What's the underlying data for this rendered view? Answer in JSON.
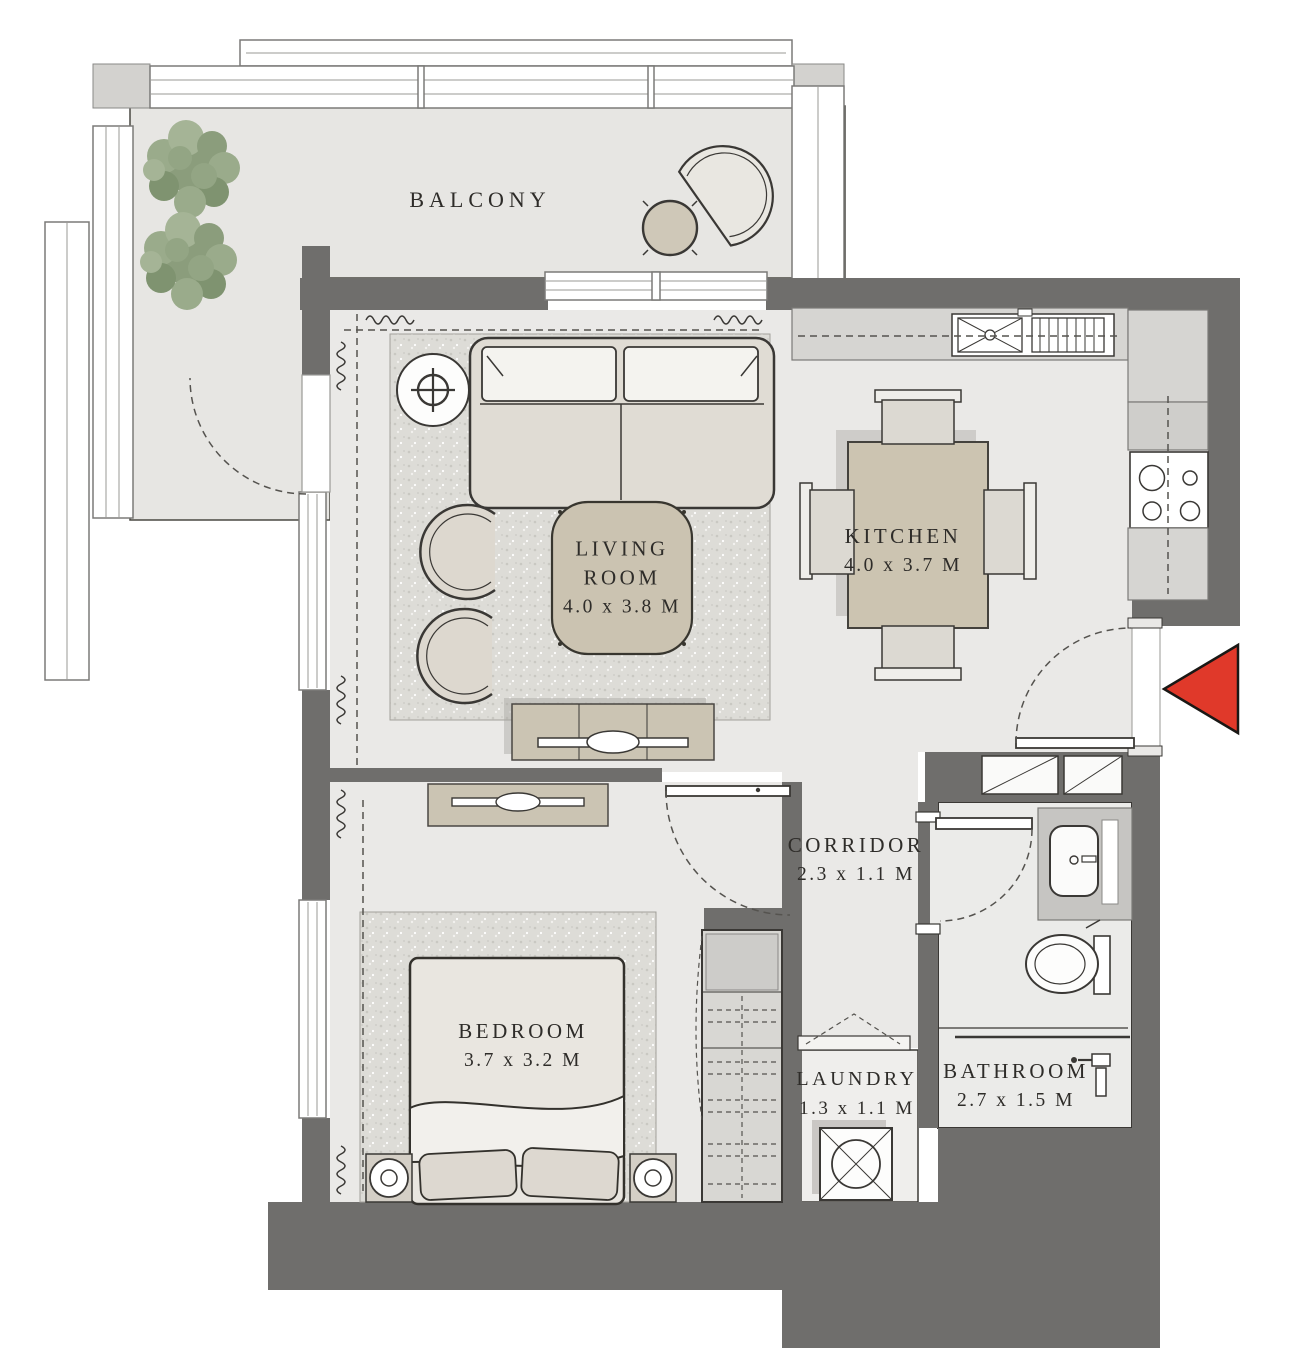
{
  "plan": {
    "type": "apartment-floor-plan",
    "rooms": {
      "balcony": {
        "name": "BALCONY"
      },
      "living_room": {
        "name_line1": "LIVING",
        "name_line2": "ROOM",
        "dims": "4.0 x 3.8 M"
      },
      "kitchen": {
        "name": "KITCHEN",
        "dims": "4.0 x 3.7 M"
      },
      "corridor": {
        "name": "CORRIDOR",
        "dims": "2.3 x 1.1 M"
      },
      "bedroom": {
        "name": "BEDROOM",
        "dims": "3.7 x 3.2 M"
      },
      "laundry": {
        "name": "LAUNDRY",
        "dims": "1.3 x 1.1 M"
      },
      "bathroom": {
        "name": "BATHROOM",
        "dims": "2.7 x 1.5 M"
      }
    },
    "colors": {
      "wall": "#6f6e6c",
      "floor": "#eae9e7",
      "balcony_floor": "#e7e6e3",
      "carpet": "#dcdbd6",
      "furniture_beige": "#cbc3b2",
      "tree_green": "#93a584",
      "entry_arrow": "#e0392a",
      "outline": "#3a3835",
      "text": "#2e2c29"
    },
    "icons": [
      "tree-icon",
      "balcony-chair-icon",
      "balcony-table-icon",
      "sofa-icon",
      "floor-lamp-icon",
      "armchair-icon",
      "pouf-icon",
      "tv-console-icon",
      "dining-table-icon",
      "dining-chair-icon",
      "kitchen-sink-icon",
      "stove-icon",
      "bed-icon",
      "nightstand-icon",
      "wardrobe-icon",
      "dresser-icon",
      "washing-machine-icon",
      "vanity-sink-icon",
      "toilet-icon",
      "shower-icon",
      "entry-arrow-icon",
      "door-swing-icon",
      "closet-icon",
      "curtain-icon"
    ]
  }
}
